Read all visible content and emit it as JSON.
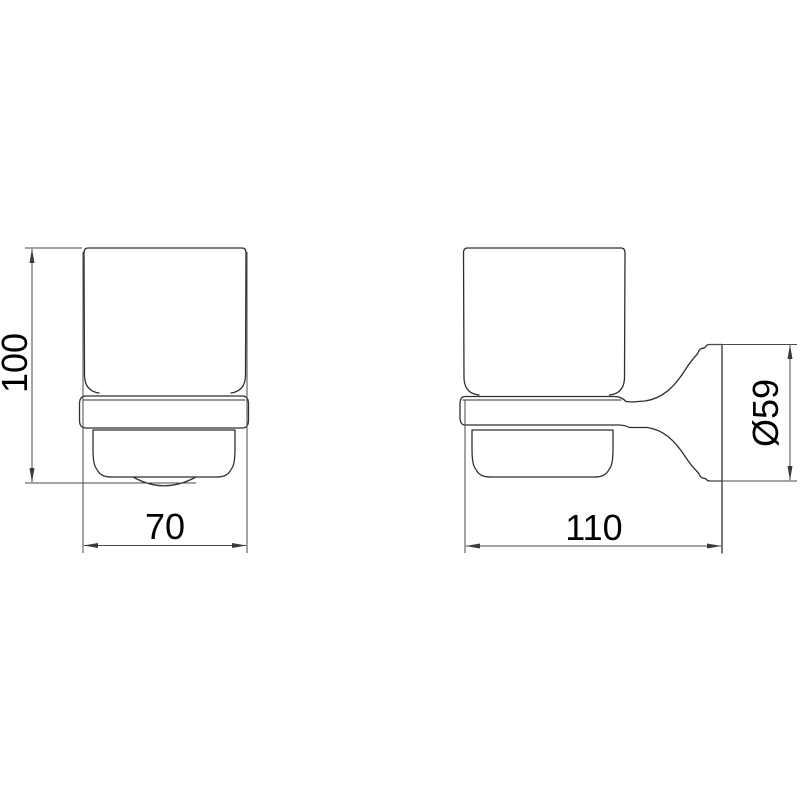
{
  "drawing": {
    "background_color": "#ffffff",
    "line_color": "#2f2f2f",
    "dimension_color": "#4a4a4a",
    "text_color": "#000000",
    "dimensions": {
      "height": {
        "label": "100"
      },
      "width": {
        "label": "70"
      },
      "depth": {
        "label": "110"
      },
      "diameter": {
        "label": "Ø59"
      }
    }
  }
}
